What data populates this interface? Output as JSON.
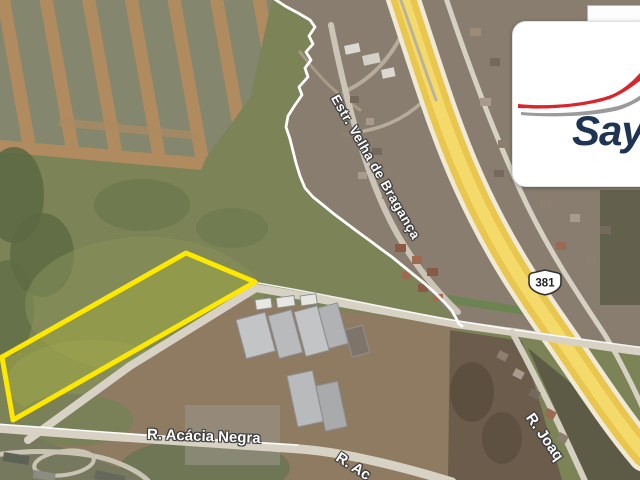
{
  "map": {
    "view": "satellite",
    "route_shield": {
      "number": "381"
    },
    "road_labels": [
      {
        "id": "estrada-velha-de-braganca",
        "text": "Estr. Velha de Bragança"
      },
      {
        "id": "rua-acacia-negra",
        "text": "R. Acácia Negra"
      },
      {
        "id": "rua-acacia-negra-2",
        "text": "R. Ac"
      },
      {
        "id": "rua-joaquim",
        "text": "R. Joaq"
      }
    ],
    "highlight": {
      "parcel_outline_color": "#ffe800",
      "boundary_line_color": "#ffffff"
    },
    "highway_color": "#e9c64d"
  },
  "logo": {
    "brand_text": "Say",
    "swoosh_primary_color": "#d9262b",
    "swoosh_secondary_color": "#9a9a9a",
    "text_color": "#1d3452"
  }
}
